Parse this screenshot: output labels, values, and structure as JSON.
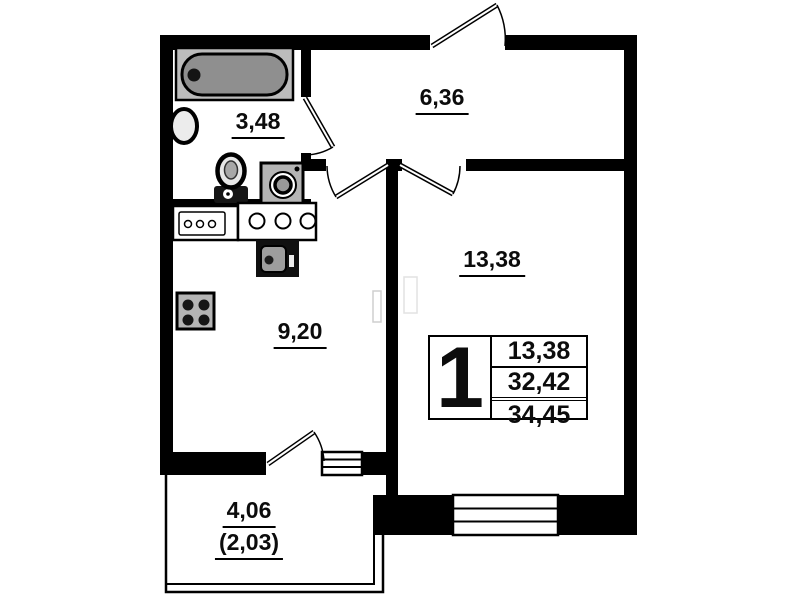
{
  "floor_plan": {
    "rooms": [
      {
        "id": "bathroom",
        "area": "3,48"
      },
      {
        "id": "hallway",
        "area": "6,36"
      },
      {
        "id": "living_room",
        "area": "13,38"
      },
      {
        "id": "kitchen",
        "area": "9,20"
      },
      {
        "id": "balcony",
        "area": "4,06",
        "area_reduced": "(2,03)"
      }
    ],
    "legend": {
      "rooms_count": "1",
      "living_area": "13,38",
      "apartment_area": "32,42",
      "total_area": "34,45"
    },
    "fixtures": [
      "bathtub",
      "wash-basin",
      "toilet",
      "washing-machine",
      "kitchen-counter",
      "kitchen-sink",
      "oven",
      "stove",
      "entrance-door",
      "bathroom-door",
      "kitchen-door",
      "living-room-door",
      "balcony-door",
      "living-room-window",
      "balcony-window",
      "balcony-parapet"
    ],
    "colors": {
      "wall": "#000000",
      "tub_fill": "#8f8f8f",
      "fixture_fill": "#b5b5b5",
      "background": "#ffffff"
    }
  }
}
